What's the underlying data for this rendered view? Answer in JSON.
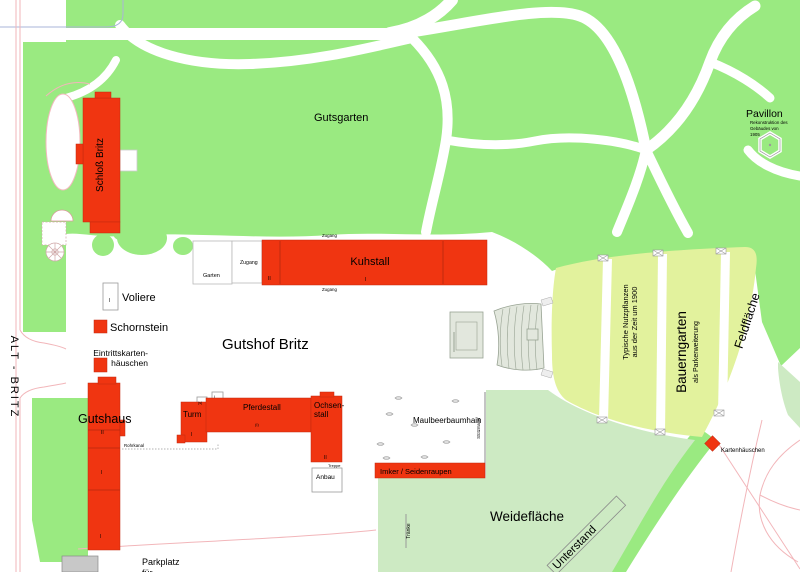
{
  "map": {
    "streets": {
      "alt_britz": "ALT - BRITZ"
    },
    "park": {
      "gutsgarten": "Gutsgarten",
      "pavillon": "Pavillon",
      "pavillon_sub1": "Rekonstruktion des",
      "pavillon_sub2": "Gebäudes von",
      "pavillon_sub3": "1905"
    },
    "buildings": {
      "schloss": "Schloß Britz",
      "gutshof": "Gutshof Britz",
      "voliere": "Voliere",
      "schornstein": "Schornstein",
      "eintritt_line1": "Eintrittskarten-",
      "eintritt_line2": "häuschen",
      "kuhstall": "Kuhstall",
      "zugang_box": "Zugang",
      "zugang_top": "Zugang",
      "zugang_bottom": "Zugang",
      "garten": "Garten",
      "gutshaus": "Gutshaus",
      "rohrkanal": "Rohrkanal",
      "turm": "Turm",
      "pferdestall": "Pferdestall",
      "ochsenstall_line1": "Ochsen-",
      "ochsenstall_line2": "stall",
      "treppe": "Treppe",
      "anbau": "Anbau",
      "imker": "Imker / Seidenraupen",
      "kartenhaeuschen": "Kartenhäuschen"
    },
    "areas": {
      "maulbeerbaumhain": "Maulbeerbaumhain",
      "stuetzmauer": "Stützmauer",
      "weideflaeche": "Weidefläche",
      "traenke": "Tränke",
      "unterstand": "Unterstand",
      "parkplatz_line1": "Parkplatz",
      "parkplatz_line2": "für",
      "nutzpflanzen_line1": "Typische Nutzpflanzen",
      "nutzpflanzen_line2": "aus der Zeit um 1900",
      "bauerngarten": "Bauerngarten",
      "bauerngarten_sub": "als Parkerweiterung",
      "feldflaeche": "Feldfläche"
    },
    "marks": {
      "m1": "II",
      "m2": "I",
      "m3": "I",
      "m4": "II",
      "m5": "I",
      "m6": "I",
      "m7": "I",
      "m8": "(s)",
      "m9": "(I)",
      "m10": "II",
      "m11": "I"
    },
    "colors": {
      "park_green": "#9aea81",
      "field_yellow": "#e2f29d",
      "meadow_green": "#cdeac3",
      "building_red": "#f03511",
      "road_pink": "#f2b6ba",
      "street_border": "#a9b4d8",
      "building_gray": "#c8c8c8"
    }
  }
}
